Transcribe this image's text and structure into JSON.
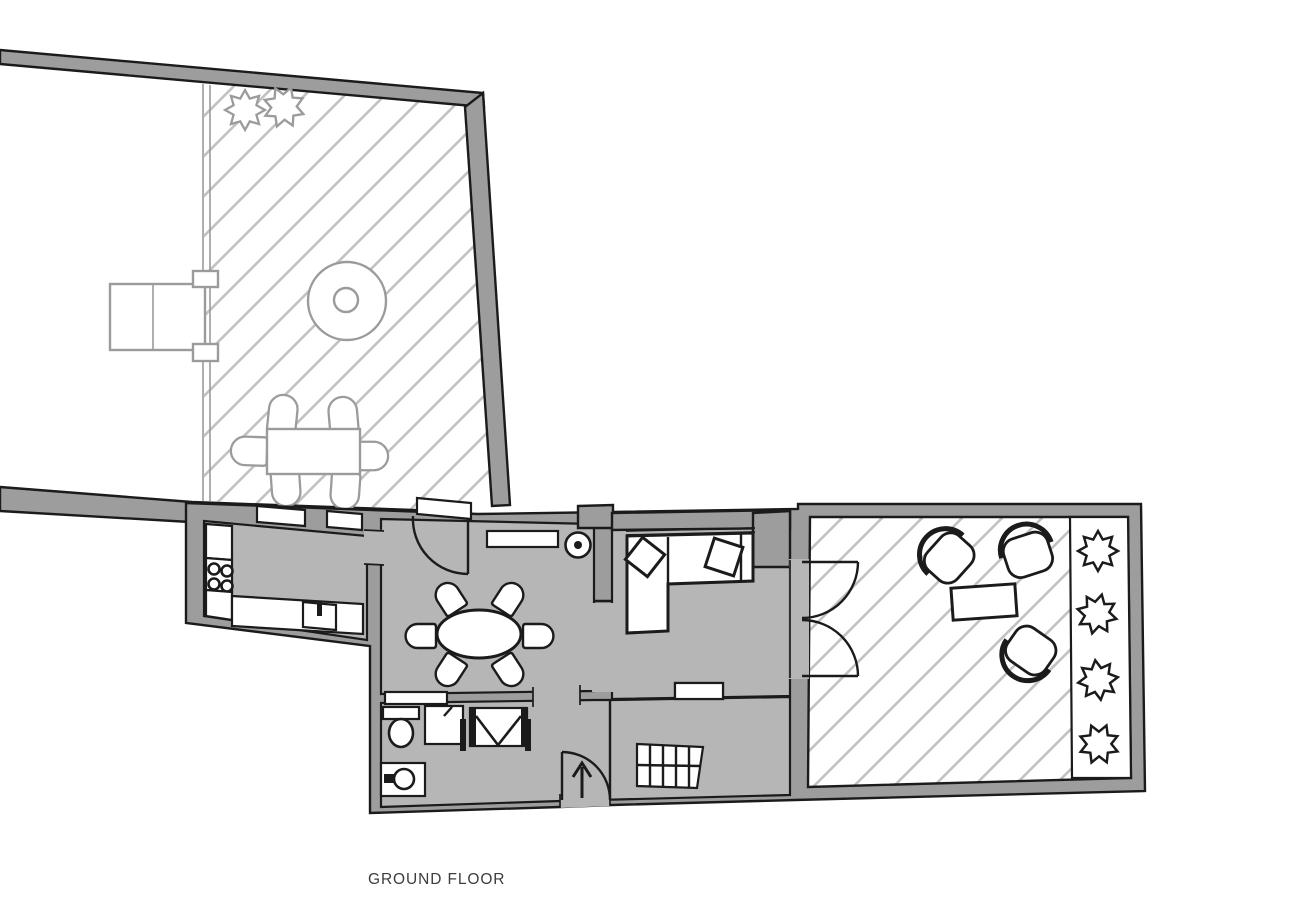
{
  "plan": {
    "title": "GROUND FLOOR"
  },
  "colors": {
    "wall": "#9d9d9d",
    "floor": "#b6b6b6",
    "outline": "#1b1b1b",
    "hatch": "#c2c2c2",
    "garden": "#9b9b9b",
    "bg": "#ffffff",
    "text": "#3d3d3d"
  },
  "inventory": {
    "garden_terrace": [
      "hedge-bush x2",
      "round-table",
      "dining-table",
      "chairs x6",
      "gate"
    ],
    "kitchen": [
      "stove-4-burners",
      "counters",
      "sink",
      "windows x2"
    ],
    "dining_room": [
      "oval-table",
      "chairs x6",
      "sideboard",
      "door",
      "round-marker"
    ],
    "living_room": [
      "corner-sofa",
      "cushions x2",
      "window",
      "double-doors"
    ],
    "bathroom": [
      "toilet",
      "washbasin",
      "shower",
      "wardrobe",
      "window"
    ],
    "entrance": [
      "entry-door",
      "direction-arrow",
      "staircase",
      "window"
    ],
    "roof_terrace": [
      "armchairs x3",
      "coffee-table",
      "planter-strip",
      "shrubs x4"
    ]
  }
}
